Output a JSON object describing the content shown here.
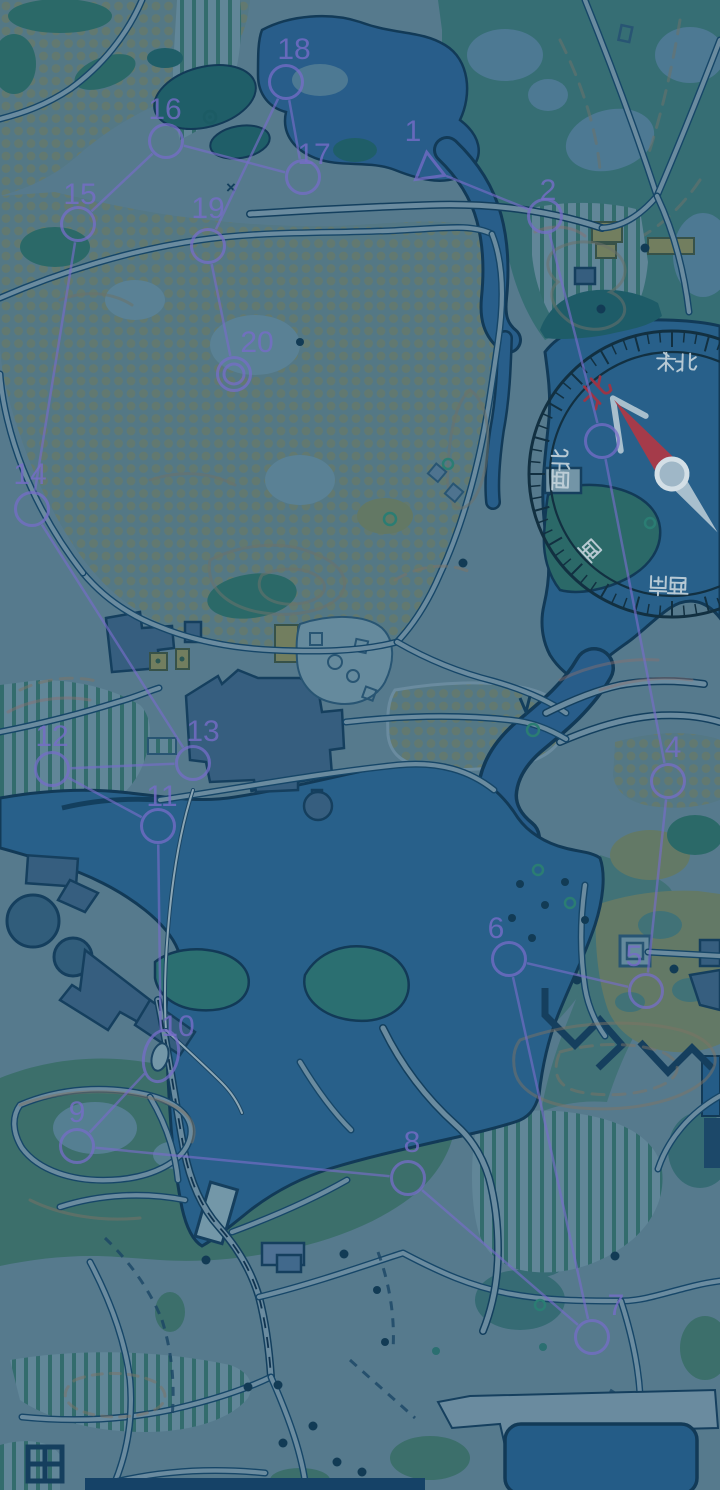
{
  "scene": {
    "type": "orienteering-map-night-view",
    "width": 720,
    "height": 1490
  },
  "palette": {
    "ground": "#5E8294",
    "path_fill": "#7495A8",
    "path_casing": "#17486A",
    "water": "#2B6290",
    "lake": "#2B6590",
    "pool": "#26608D",
    "water_outline": "#123A57",
    "forest_dark": "#20606A",
    "forest_mid": "#2E6F6A",
    "park_green": "#3A7478",
    "garden_green": "#41756E",
    "island_green": "#2E7574",
    "dotted_bg": "#5C7F8B",
    "dotted_dot": "#72806A",
    "stripe_green": "#2A6A64",
    "building": "#3A6384",
    "building_outline": "#16405F",
    "khaki": "#7D8660",
    "tan_ground": "#6D8168",
    "course_purple": "#8273D6"
  },
  "course": {
    "color": "#8273D6",
    "controls": [
      {
        "id": "start",
        "label": "1",
        "x": 429,
        "y": 169,
        "shape": "triangle",
        "label_x": 413,
        "label_y": 141
      },
      {
        "id": "c2",
        "label": "2",
        "x": 545,
        "y": 216,
        "shape": "circle",
        "label_x": 548,
        "label_y": 200
      },
      {
        "id": "c3",
        "label": "",
        "x": 602,
        "y": 441,
        "shape": "circle",
        "label_x": 0,
        "label_y": 0
      },
      {
        "id": "c4",
        "label": "4",
        "x": 668,
        "y": 781,
        "shape": "circle",
        "label_x": 673,
        "label_y": 757
      },
      {
        "id": "c5",
        "label": "5",
        "x": 646,
        "y": 991,
        "shape": "circle",
        "label_x": 634,
        "label_y": 966
      },
      {
        "id": "c6",
        "label": "6",
        "x": 509,
        "y": 959,
        "shape": "circle",
        "label_x": 496,
        "label_y": 938
      },
      {
        "id": "c7",
        "label": "7",
        "x": 592,
        "y": 1337,
        "shape": "circle",
        "label_x": 616,
        "label_y": 1315
      },
      {
        "id": "c8",
        "label": "8",
        "x": 408,
        "y": 1178,
        "shape": "circle",
        "label_x": 412,
        "label_y": 1152
      },
      {
        "id": "c9",
        "label": "9",
        "x": 77,
        "y": 1146,
        "shape": "circle",
        "label_x": 77,
        "label_y": 1122
      },
      {
        "id": "c10",
        "label": "10",
        "x": 161,
        "y": 1056,
        "shape": "oval",
        "label_x": 178,
        "label_y": 1036
      },
      {
        "id": "c11",
        "label": "11",
        "x": 158,
        "y": 826,
        "shape": "circle",
        "label_x": 162,
        "label_y": 806
      },
      {
        "id": "c12",
        "label": "12",
        "x": 52,
        "y": 769,
        "shape": "circle",
        "label_x": 52,
        "label_y": 746
      },
      {
        "id": "c13",
        "label": "13",
        "x": 193,
        "y": 763,
        "shape": "circle",
        "label_x": 203,
        "label_y": 741
      },
      {
        "id": "c14",
        "label": "14",
        "x": 32,
        "y": 509,
        "shape": "circle",
        "label_x": 30,
        "label_y": 484
      },
      {
        "id": "c15",
        "label": "15",
        "x": 78,
        "y": 224,
        "shape": "circle",
        "label_x": 80,
        "label_y": 204
      },
      {
        "id": "c16",
        "label": "16",
        "x": 166,
        "y": 141,
        "shape": "circle",
        "label_x": 165,
        "label_y": 119
      },
      {
        "id": "c17",
        "label": "17",
        "x": 303,
        "y": 177,
        "shape": "circle",
        "label_x": 314,
        "label_y": 164
      },
      {
        "id": "c18",
        "label": "18",
        "x": 286,
        "y": 82,
        "shape": "circle",
        "label_x": 294,
        "label_y": 59
      },
      {
        "id": "c19",
        "label": "19",
        "x": 208,
        "y": 246,
        "shape": "circle",
        "label_x": 208,
        "label_y": 218
      },
      {
        "id": "c20",
        "label": "20",
        "x": 234,
        "y": 374,
        "shape": "double-circle",
        "label_x": 257,
        "label_y": 352
      }
    ]
  },
  "compass": {
    "center_x": 672,
    "center_y": 474,
    "outer_r": 143,
    "inner_r": 122,
    "ring_color": "#122F3F",
    "label_color": "#D8E4EA",
    "north_color": "#B5323F",
    "needle": {
      "bearing": -38,
      "front_color": "#BE3A46",
      "back_color": "#C9D9E3",
      "pivot_fill": "#AFC6D4",
      "pivot_ring": "#E9F2F6"
    },
    "labels": [
      {
        "text": "北",
        "bearing": -43,
        "emphasis": true
      },
      {
        "text": "东北",
        "bearing": 2,
        "emphasis": false
      },
      {
        "text": "西北",
        "bearing": -88,
        "emphasis": false
      },
      {
        "text": "西",
        "bearing": -133,
        "emphasis": false
      },
      {
        "text": "西南",
        "bearing": -178,
        "emphasis": false
      }
    ]
  }
}
